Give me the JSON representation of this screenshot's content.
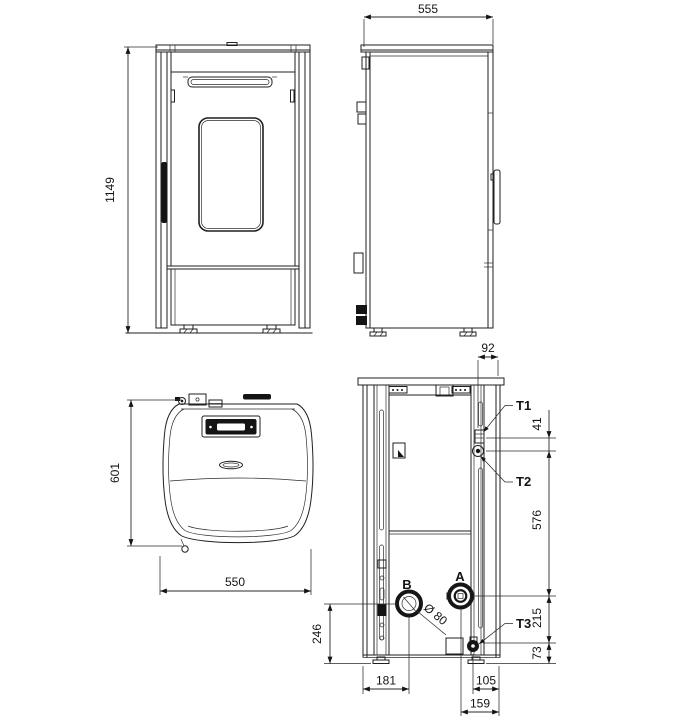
{
  "views": {
    "front": {
      "dim_height": "1149"
    },
    "side": {
      "dim_depth": "555"
    },
    "top": {
      "dim_depth": "601",
      "dim_width": "550"
    },
    "rear": {
      "dim_right_offset": "92",
      "dim_t1_t2": "41",
      "dim_t2_a": "576",
      "dim_a_t3": "215",
      "dim_t3_floor": "73",
      "dim_b_floor": "246",
      "dim_left_to_b": "181",
      "dim_t3_to_right": "105",
      "dim_a_to_right": "159",
      "label_t1": "T1",
      "label_t2": "T2",
      "label_t3": "T3",
      "label_a": "A",
      "label_b": "B",
      "label_flue_diameter": "Ø 80"
    }
  }
}
